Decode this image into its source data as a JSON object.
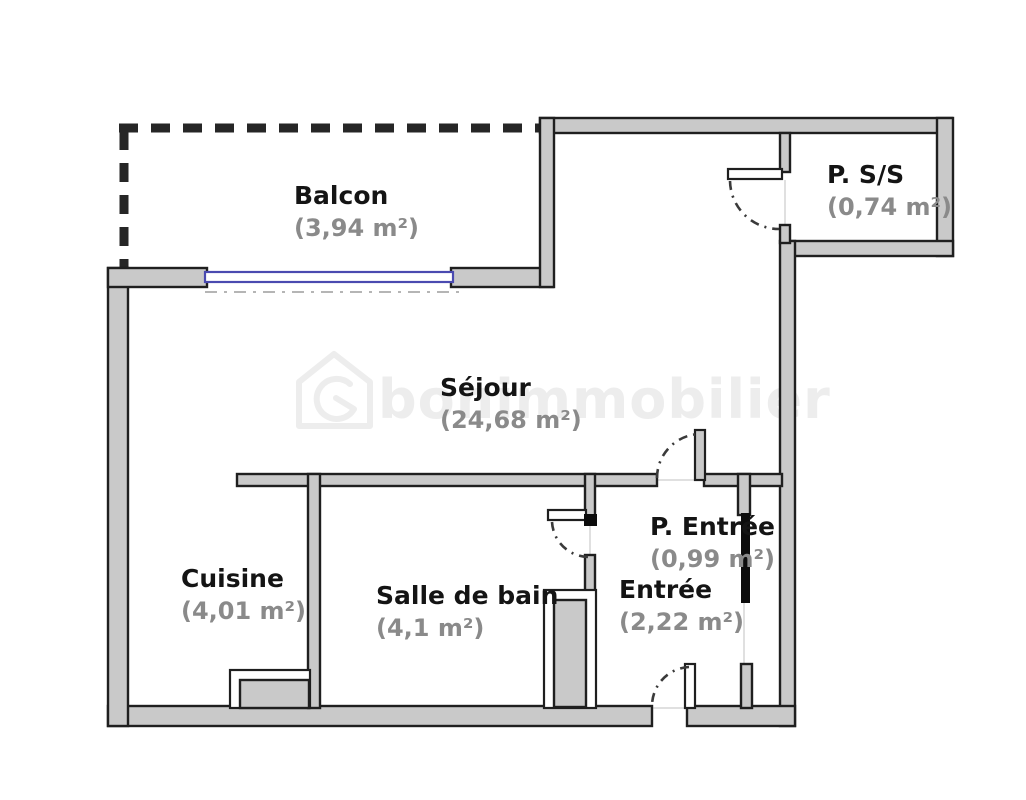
{
  "plan": {
    "title": "Plan d'appartement",
    "watermark": "bonimmobilier",
    "rooms": [
      {
        "id": "balcon",
        "name": "Balcon",
        "area": "(3,94 m²)"
      },
      {
        "id": "p-ss",
        "name": "P. S/S",
        "area": "(0,74 m²)"
      },
      {
        "id": "sejour",
        "name": "Séjour",
        "area": "(24,68 m²)"
      },
      {
        "id": "cuisine",
        "name": "Cuisine",
        "area": "(4,01 m²)"
      },
      {
        "id": "salle-de-bain",
        "name": "Salle de bain",
        "area": "(4,1 m²)"
      },
      {
        "id": "p-entree",
        "name": "P. Entrée",
        "area": "(0,99 m²)"
      },
      {
        "id": "entree",
        "name": "Entrée",
        "area": "(2,22 m²)"
      }
    ],
    "colors": {
      "background": "#ffffff",
      "wall_fill": "#c9c9c9",
      "wall_stroke": "#1f1f1f",
      "window_blue": "#4a4ab0",
      "balcony_dash": "#262626",
      "room_name_color": "#141414",
      "area_color": "#8a8a8a",
      "watermark_color": "#ededed"
    }
  }
}
